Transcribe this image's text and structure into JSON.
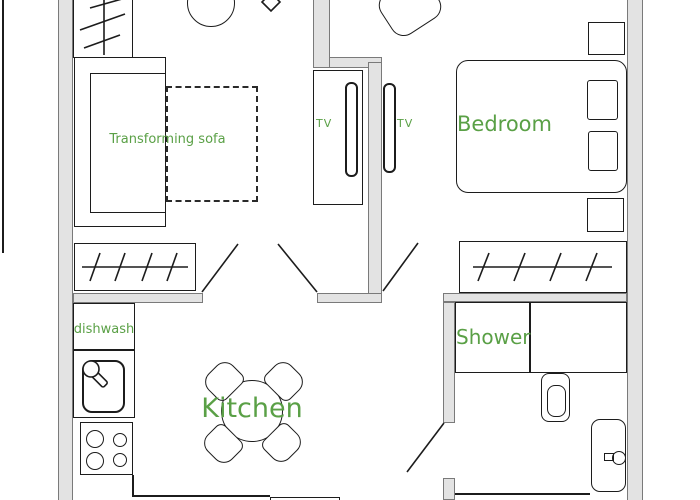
{
  "title": "Apartment floor plan",
  "colors": {
    "label": "#5aa046",
    "wall_fill": "#e3e3e3",
    "wall_edge": "#7a7a7a",
    "ink": "#1c1c1c"
  },
  "rooms": {
    "living": {
      "sofa_label": "Transforming sofa",
      "tv_label": "TV"
    },
    "bedroom": {
      "name": "Bedroom",
      "tv_label": "TV"
    },
    "kitchen": {
      "name": "Kitchen",
      "dishwasher_label": "dishwash"
    },
    "bathroom": {
      "shower_label": "Shower"
    }
  }
}
